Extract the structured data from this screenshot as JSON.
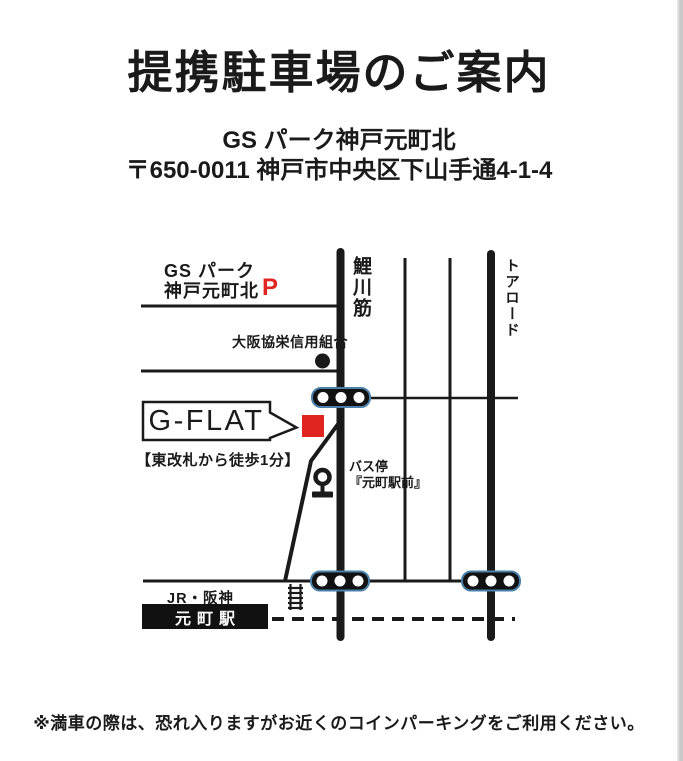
{
  "page": {
    "title": "提携駐車場のご案内",
    "facility_name": "GS パーク神戸元町北",
    "facility_address": "〒650-0011 神戸市中央区下山手通4-1-4",
    "footer_note": "※満車の際は、恐れ入りますがお近くのコインパーキングをご利用ください。"
  },
  "map": {
    "parking_name_line1": "GS パーク",
    "parking_name_line2": "神戸元町北",
    "parking_symbol": "P",
    "road_koikawa": "鯉川筋",
    "road_toa": "トアロード",
    "bank_label": "大阪協栄信用組合",
    "destination_label": "G-FLAT",
    "walk_note": "【東改札から徒歩1分】",
    "bus_stop_line1": "バス停",
    "bus_stop_line2": "『元町駅前』",
    "rail_label": "JR・阪神",
    "station_label": "元町駅",
    "icons": {
      "traffic_signal": "traffic-signal-icon",
      "bus_stop": "bus-stop-icon",
      "bank_dot": "bank-dot-icon",
      "stairs": "stairs-icon",
      "destination_marker": "destination-marker-icon",
      "parking_mark": "parking-p-icon"
    }
  },
  "colors": {
    "accent_red": "#e02420",
    "signal_outline": "#4a80aa",
    "ink": "#1a1a1a",
    "station_box": "#111111",
    "page_edge_gray": "#c9c9c9"
  }
}
